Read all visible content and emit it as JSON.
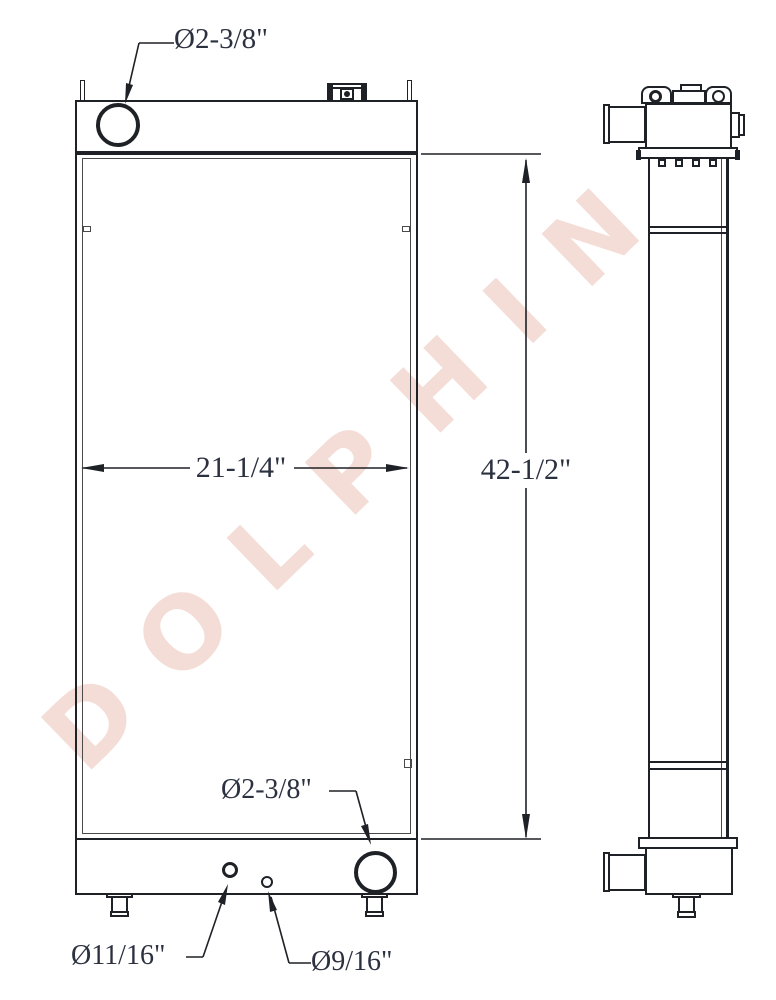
{
  "watermark": {
    "text": "DOLPHIN",
    "color": "#f4ddd6"
  },
  "labels": {
    "top_port_diameter": "Ø2-3/8\"",
    "core_width": "21-1/4\"",
    "overall_height": "42-1/2\"",
    "bottom_port_diameter": "Ø2-3/8\"",
    "left_hole_diameter": "Ø11/16\"",
    "right_hole_diameter": "Ø9/16\""
  },
  "colors": {
    "line": "#1e2126",
    "dimension_text": "#2c3140"
  }
}
